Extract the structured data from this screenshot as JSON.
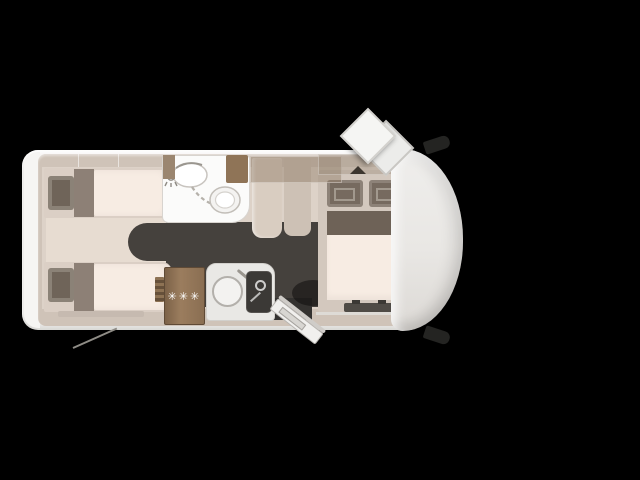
{
  "floorplan": {
    "subject": "motorhome-top-view-floorplan",
    "fridge": {
      "star_rating": "✳✳✳"
    },
    "icons": {
      "skylight": "diamond-rooflight-open",
      "side_mirror": "cab-side-mirror",
      "shower": "shower-head",
      "toilet": "toilet-bowl",
      "bath_sink": "washbasin",
      "kitchen_sink": "round-sink",
      "hob": "hob-with-kettle",
      "entry_door": "open-entry-door",
      "freezer_rating": "three-star-freezer"
    },
    "colors": {
      "bg": "#000000",
      "shell": "#f3f2ef",
      "wall": "#cfc3b8",
      "floor": "#ddd2c8",
      "floor-dark": "#45413d",
      "mattress": "#f7ece3",
      "bedframe": "#dbcfc5",
      "pillow": "#6f6459",
      "pillow-light": "#8d8076",
      "wood": "#8f7457",
      "bath": "#fbfbfa",
      "counter": "#e9e8e5",
      "hob": "#3b3936",
      "star": "#ffffff"
    }
  }
}
